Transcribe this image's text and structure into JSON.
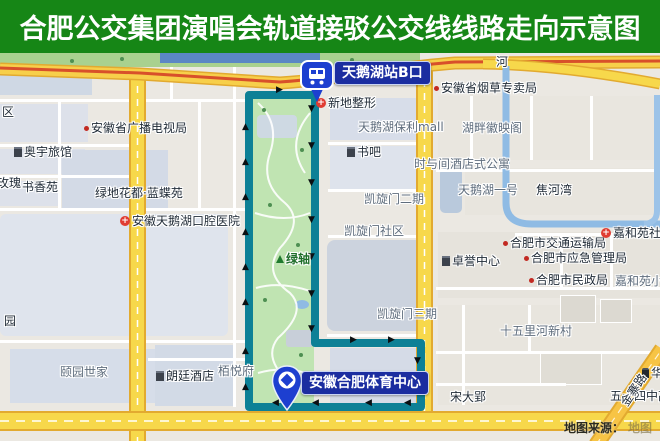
{
  "banner": {
    "title": "合肥公交集团演唱会轨道接驳公交线线路走向示意图",
    "bg": "#168616",
    "fg": "#ffffff"
  },
  "route": {
    "color": "#0d8096",
    "station_label": "天鹅湖站B口",
    "destination_label": "安徽合肥体育中心",
    "label_bg": "#1b2da0",
    "arrows": [
      {
        "d": "up",
        "x": 242,
        "y": 70
      },
      {
        "d": "up",
        "x": 242,
        "y": 105
      },
      {
        "d": "up",
        "x": 242,
        "y": 140
      },
      {
        "d": "up",
        "x": 242,
        "y": 175
      },
      {
        "d": "up",
        "x": 242,
        "y": 210
      },
      {
        "d": "up",
        "x": 242,
        "y": 245
      },
      {
        "d": "up",
        "x": 242,
        "y": 294
      },
      {
        "d": "up",
        "x": 242,
        "y": 330
      },
      {
        "d": "down",
        "x": 308,
        "y": 52
      },
      {
        "d": "down",
        "x": 308,
        "y": 89
      },
      {
        "d": "down",
        "x": 308,
        "y": 126
      },
      {
        "d": "down",
        "x": 308,
        "y": 163
      },
      {
        "d": "down",
        "x": 308,
        "y": 200
      },
      {
        "d": "down",
        "x": 308,
        "y": 237
      },
      {
        "d": "down",
        "x": 308,
        "y": 272
      },
      {
        "d": "right",
        "x": 276,
        "y": 33
      },
      {
        "d": "right",
        "x": 350,
        "y": 283
      },
      {
        "d": "right",
        "x": 388,
        "y": 283
      },
      {
        "d": "down",
        "x": 414,
        "y": 304
      },
      {
        "d": "down",
        "x": 414,
        "y": 330
      },
      {
        "d": "left",
        "x": 272,
        "y": 346
      },
      {
        "d": "left",
        "x": 312,
        "y": 346
      },
      {
        "d": "left",
        "x": 365,
        "y": 346
      },
      {
        "d": "left",
        "x": 404,
        "y": 346
      }
    ]
  },
  "map": {
    "labels": [
      {
        "text": "区",
        "x": 2,
        "y": 52,
        "cls": "dark"
      },
      {
        "text": "安徽省广播电视局",
        "x": 84,
        "y": 68,
        "icon": "dot"
      },
      {
        "text": "奥宇旅馆",
        "x": 14,
        "y": 92,
        "icon": "building"
      },
      {
        "text": "玫瑰",
        "x": -3,
        "y": 123,
        "cls": "dark"
      },
      {
        "text": "书香苑",
        "x": 22,
        "y": 127,
        "cls": "dark"
      },
      {
        "text": "绿地花都·蓝蝶苑",
        "x": 95,
        "y": 133,
        "cls": "dark"
      },
      {
        "text": "安徽天鹅湖口腔医院",
        "x": 120,
        "y": 161,
        "icon": "cross"
      },
      {
        "text": "园",
        "x": 4,
        "y": 261,
        "cls": "dark"
      },
      {
        "text": "颐园世家",
        "x": 60,
        "y": 312,
        "cls": "gray"
      },
      {
        "text": "朗廷酒店",
        "x": 156,
        "y": 316,
        "icon": "building"
      },
      {
        "text": "栢悦府",
        "x": 218,
        "y": 311,
        "cls": "gray"
      },
      {
        "text": "新地整形",
        "x": 316,
        "y": 43,
        "icon": "cross"
      },
      {
        "text": "天鹅湖保利mall",
        "x": 358,
        "y": 67,
        "cls": "gray"
      },
      {
        "text": "湖畔徽映阁",
        "x": 462,
        "y": 68,
        "cls": "gray"
      },
      {
        "text": "书吧",
        "x": 347,
        "y": 92,
        "icon": "building"
      },
      {
        "text": "时与间酒店式公寓",
        "x": 414,
        "y": 104,
        "cls": "gray"
      },
      {
        "text": "天鹅湖一号",
        "x": 458,
        "y": 130,
        "cls": "gray"
      },
      {
        "text": "焦河湾",
        "x": 536,
        "y": 130,
        "cls": "dark"
      },
      {
        "text": "凯旋门二期",
        "x": 364,
        "y": 139,
        "cls": "gray"
      },
      {
        "text": "凯旋门社区",
        "x": 344,
        "y": 171,
        "cls": "gray"
      },
      {
        "text": "绿轴",
        "x": 276,
        "y": 199,
        "icon": "tree",
        "cls": "green"
      },
      {
        "text": "凯旋门三期",
        "x": 377,
        "y": 254,
        "cls": "gray"
      },
      {
        "text": "卓誉中心",
        "x": 442,
        "y": 201,
        "icon": "building"
      },
      {
        "text": "合肥市交通运输局",
        "x": 503,
        "y": 183,
        "icon": "dot"
      },
      {
        "text": "合肥市应急管理局",
        "x": 524,
        "y": 198,
        "icon": "dot"
      },
      {
        "text": "合肥市民政局",
        "x": 529,
        "y": 220,
        "icon": "dot"
      },
      {
        "text": "嘉和苑社区",
        "x": 601,
        "y": 173,
        "icon": "cross"
      },
      {
        "text": "嘉和苑小区",
        "x": 615,
        "y": 221,
        "cls": "gray"
      },
      {
        "text": "十五里河新村",
        "x": 500,
        "y": 271,
        "cls": "gray"
      },
      {
        "text": "宋大郢",
        "x": 450,
        "y": 337,
        "cls": "dark"
      },
      {
        "text": "五十四中高",
        "x": 610,
        "y": 336,
        "cls": "dark"
      },
      {
        "text": "华",
        "x": 642,
        "y": 313,
        "icon": "shop"
      },
      {
        "text": "安徽省烟草专卖局",
        "x": 434,
        "y": 28,
        "icon": "dot"
      },
      {
        "text": "河",
        "x": 496,
        "y": 2,
        "cls": "dark"
      },
      {
        "text": "金寨路",
        "x": 618,
        "y": 348,
        "cls": "dark",
        "rotate": -56
      }
    ],
    "source_prefix": "地图来源：",
    "source_suffix": "地图"
  }
}
